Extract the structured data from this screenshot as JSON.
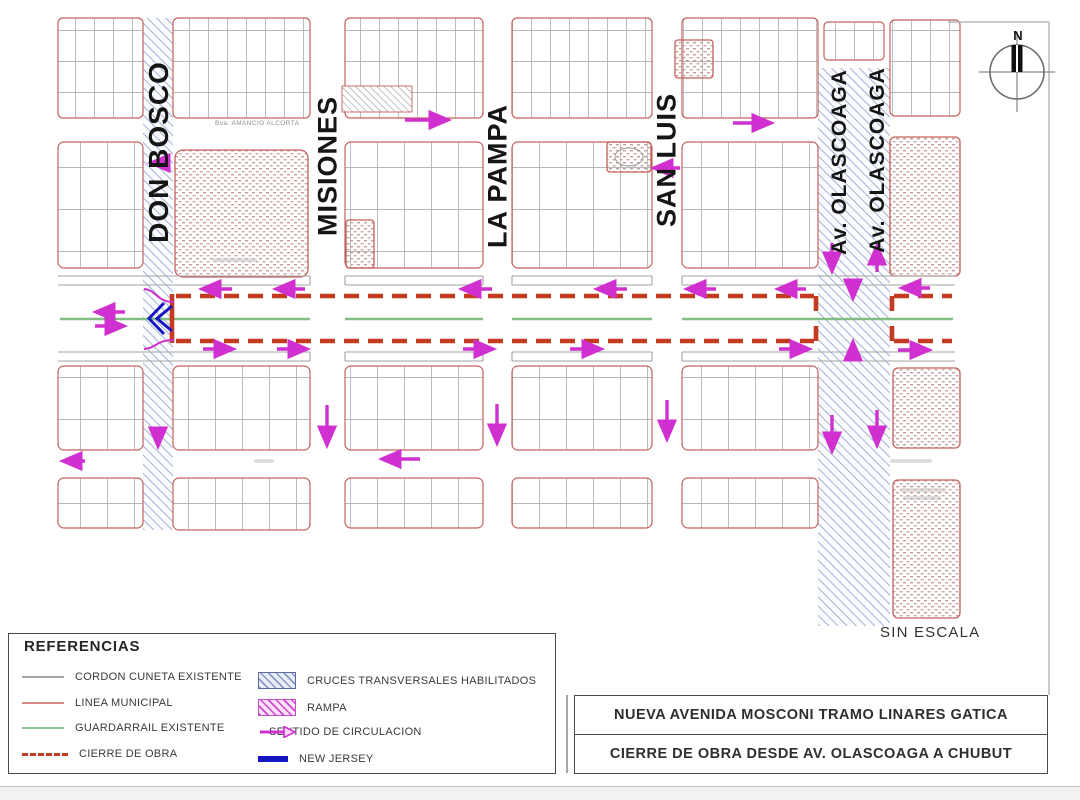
{
  "map": {
    "compass_label": "N",
    "scale_note": "SIN ESCALA",
    "street_labels": {
      "don_bosco": "DON BOSCO",
      "misiones": "MISIONES",
      "la_pampa": "LA PAMPA",
      "san_luis": "SAN LUIS",
      "olascoaga_west": "Av. OLASCOAGA",
      "olascoaga_east": "Av. OLASCOAGA",
      "top_street": "Bva. AMANCIO ALCORTA"
    }
  },
  "legend": {
    "title": "REFERENCIAS",
    "items": [
      {
        "label": "CORDON CUNETA EXISTENTE",
        "swatch": "gray-line",
        "color": "#a6a6a6"
      },
      {
        "label": "LINEA MUNICIPAL",
        "swatch": "red-line",
        "color": "#d98a86"
      },
      {
        "label": "GUARDARRAIL EXISTENTE",
        "swatch": "green-line",
        "color": "#8cc68c"
      },
      {
        "label": "CIERRE DE OBRA",
        "swatch": "red-dashed-line",
        "color": "#c53b22"
      },
      {
        "label": "CRUCES TRANSVERSALES HABILITADOS",
        "swatch": "blue-hatch",
        "color": "#8b98c4"
      },
      {
        "label": "RAMPA",
        "swatch": "magenta-hatch",
        "color": "#d63fd6"
      },
      {
        "label": "SENTIDO DE CIRCULACION",
        "swatch": "magenta-arrow",
        "color": "#cf30cf"
      },
      {
        "label": "NEW JERSEY",
        "swatch": "blue-bar",
        "color": "#1515c2"
      }
    ]
  },
  "title_block": {
    "line1": "NUEVA AVENIDA MOSCONI TRAMO LINARES GATICA",
    "line2": "CIERRE DE OBRA DESDE AV. OLASCOAGA A CHUBUT"
  },
  "colors": {
    "closure_red": "#c53b22",
    "municipal_red": "#c4615c",
    "guardrail_green": "#82bd82",
    "curb_gray": "#a3a3a3",
    "circulation_magenta": "#cf30cf",
    "new_jersey_blue": "#1515c2",
    "cross_hatch_blue": "#8b98c4"
  }
}
